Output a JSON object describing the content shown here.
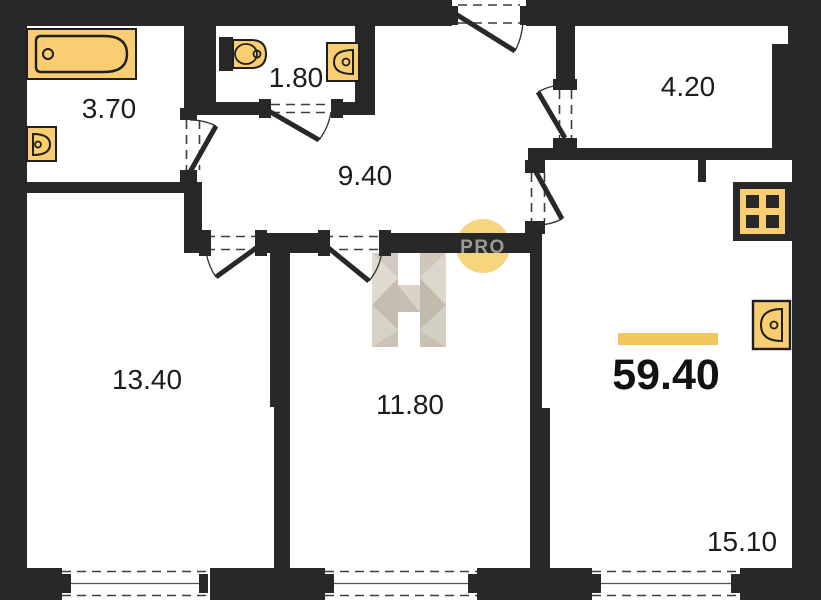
{
  "plan": {
    "rooms": [
      {
        "id": "bathroom",
        "area": "3.70"
      },
      {
        "id": "wc",
        "area": "1.80"
      },
      {
        "id": "hallway",
        "area": "9.40"
      },
      {
        "id": "storage",
        "area": "4.20"
      },
      {
        "id": "bedroom",
        "area": "13.40"
      },
      {
        "id": "room",
        "area": "11.80"
      },
      {
        "id": "kitchen-living",
        "area": "15.10"
      }
    ],
    "total_area": "59.40",
    "watermark": {
      "badge_text": "PRO"
    },
    "fixtures": [
      "bathtub",
      "bath-sink",
      "toilet",
      "wc-sink",
      "stove",
      "kitchen-sink"
    ],
    "colors": {
      "wall": "#282828",
      "fixture_fill": "#f9cd72",
      "accent_bar": "#f2c65f",
      "badge_fill": "#f5d57e",
      "badge_text": "#9c9c92",
      "watermark_light": "#ded7cc",
      "watermark_dark": "#c2baac"
    }
  }
}
